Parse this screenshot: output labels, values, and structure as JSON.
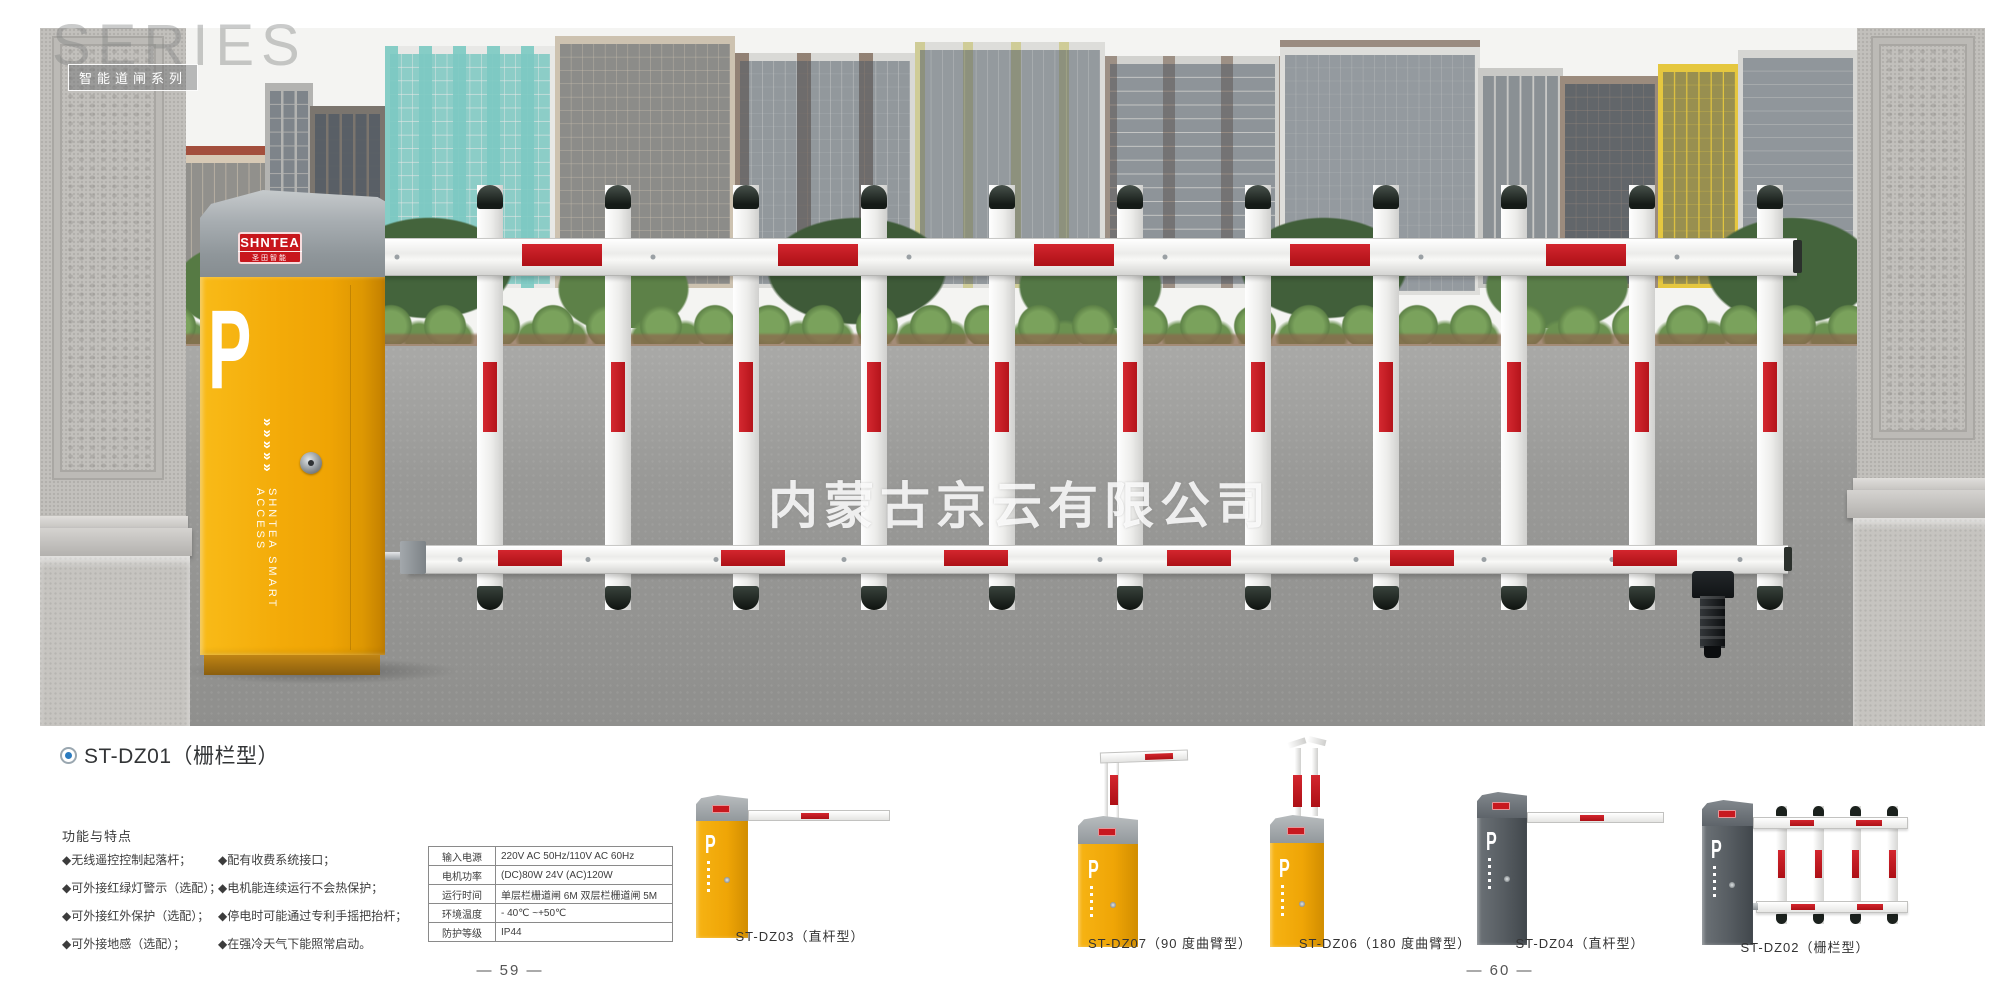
{
  "header": {
    "series_text": "SERIES",
    "series_tag": "智能道闸系列"
  },
  "photo": {
    "watermark": "内蒙古京云有限公司",
    "machine": {
      "brand": "SHNTEA",
      "brand_sub": "圣田智能",
      "parking_letter": "P",
      "side_text": "SHNTEA SMART ACCESS",
      "chevrons": "»»»»»"
    }
  },
  "product": {
    "title": "ST-DZ01（栅栏型）"
  },
  "features": {
    "heading": "功能与特点",
    "col1": [
      "◆无线遥控控制起落杆；",
      "◆可外接红绿灯警示（选配）；",
      "◆可外接红外保护（选配）；",
      "◆可外接地感（选配）；"
    ],
    "col2": [
      "◆配有收费系统接口；",
      "◆电机能连续运行不会热保护；",
      "◆停电时可能通过专利手摇把抬杆；",
      "◆在强冷天气下能照常启动。"
    ]
  },
  "specs": {
    "rows": [
      {
        "label": "输入电源",
        "value": "220V AC 50Hz/110V AC 60Hz"
      },
      {
        "label": "电机功率",
        "value": "(DC)80W 24V (AC)120W"
      },
      {
        "label": "运行时间",
        "value": "单层栏栅道闸 6M 双层栏栅道闸 5M"
      },
      {
        "label": "环境温度",
        "value": "- 40℃ ~+50℃"
      },
      {
        "label": "防护等级",
        "value": "IP44"
      }
    ]
  },
  "related": {
    "labels": [
      "ST-DZ03（直杆型）",
      "ST-DZ07（90 度曲臂型）",
      "ST-DZ06（180 度曲臂型）",
      "ST-DZ04（直杆型）",
      "ST-DZ02（栅栏型）"
    ]
  },
  "pages": {
    "left": "— 59 —",
    "right": "— 60 —"
  },
  "colors": {
    "brand_yellow": "#f2a807",
    "signal_red": "#c0181e",
    "cap_gray": "#99a0a4",
    "dark_gray": "#565c61"
  }
}
